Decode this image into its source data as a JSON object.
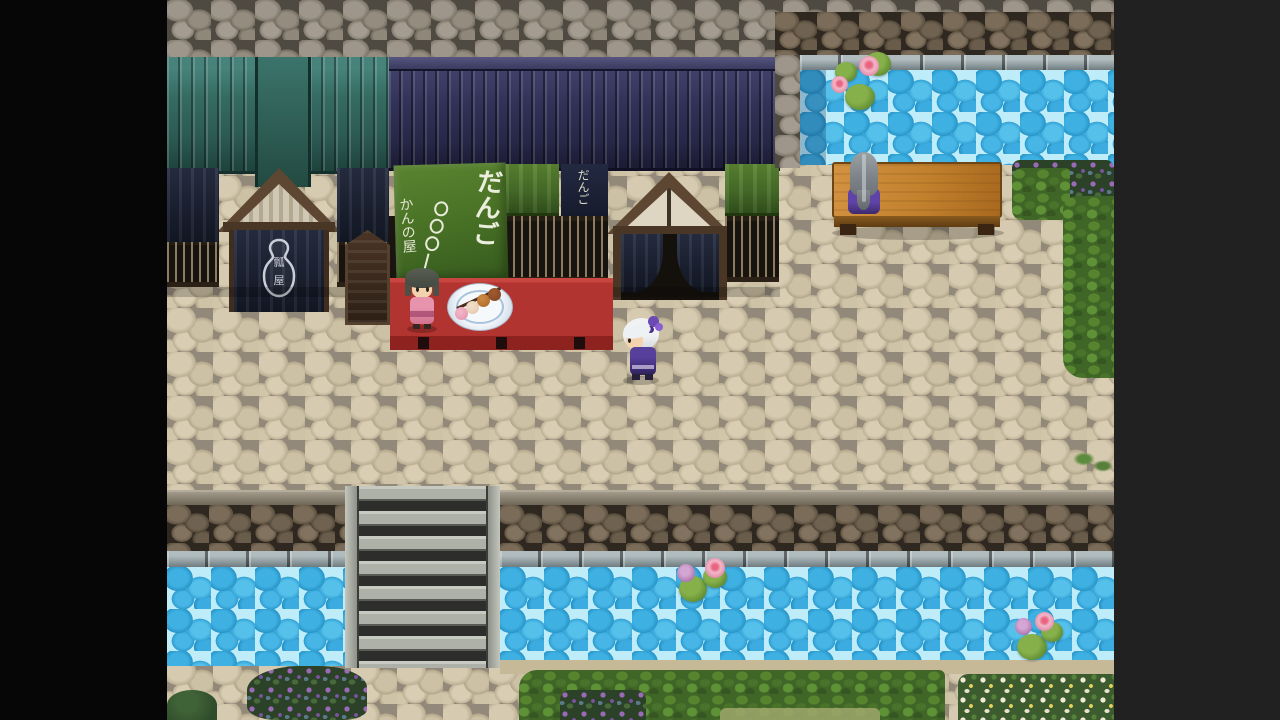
{
  "scene": {
    "label": "jrpg-town-street-dango-shop",
    "letterbox_left_color": "#060606",
    "letterbox_right_color": "#212121"
  },
  "texts": {
    "banner_dango": "だんご",
    "banner_shop": "かんの屋",
    "small_banner": "だんご",
    "emblem": "瓢屋"
  },
  "palette": {
    "street_stone": "#cfc3a6",
    "street_gap": "#93897a",
    "water_cell": "#3fb0e2",
    "water_line": "#bfecf9",
    "wall_gray": "#8f877a",
    "wall_dark_brown": "#5a4e3e",
    "roof_teal": "#356b63",
    "roof_navy": "#33335a",
    "banner_green": "#48702a",
    "noren_navy": "#1c2233",
    "table_red": "#b23430",
    "bench_wood": "#c0802c",
    "hedge_green": "#3f6527",
    "stairs_light": "#adb1a7",
    "stairs_gap": "#2d2d2b",
    "lily_pad": "#628d32",
    "lily_flower_pink": "#e08aa6",
    "lily_flower_purple": "#b07ab0"
  },
  "characters": [
    {
      "id": "shopkeeper",
      "desc": "woman with dark green bob hair in pink kimono behind stall"
    },
    {
      "id": "player",
      "desc": "white-haired character in purple outfit facing left"
    },
    {
      "id": "bench-villager",
      "desc": "long gray-haired person in purple sitting on bench"
    }
  ],
  "objects": [
    {
      "id": "dango-stall-table"
    },
    {
      "id": "dango-plate"
    },
    {
      "id": "shop-green-banner"
    },
    {
      "id": "small-dango-banner"
    },
    {
      "id": "entrance-curtain-gourd-emblem"
    },
    {
      "id": "wooden-stand"
    },
    {
      "id": "wooden-bench"
    },
    {
      "id": "stone-stairs"
    },
    {
      "id": "upper-canal"
    },
    {
      "id": "lower-canal"
    },
    {
      "id": "lily-pads"
    },
    {
      "id": "hedges-and-flowerbeds"
    }
  ]
}
